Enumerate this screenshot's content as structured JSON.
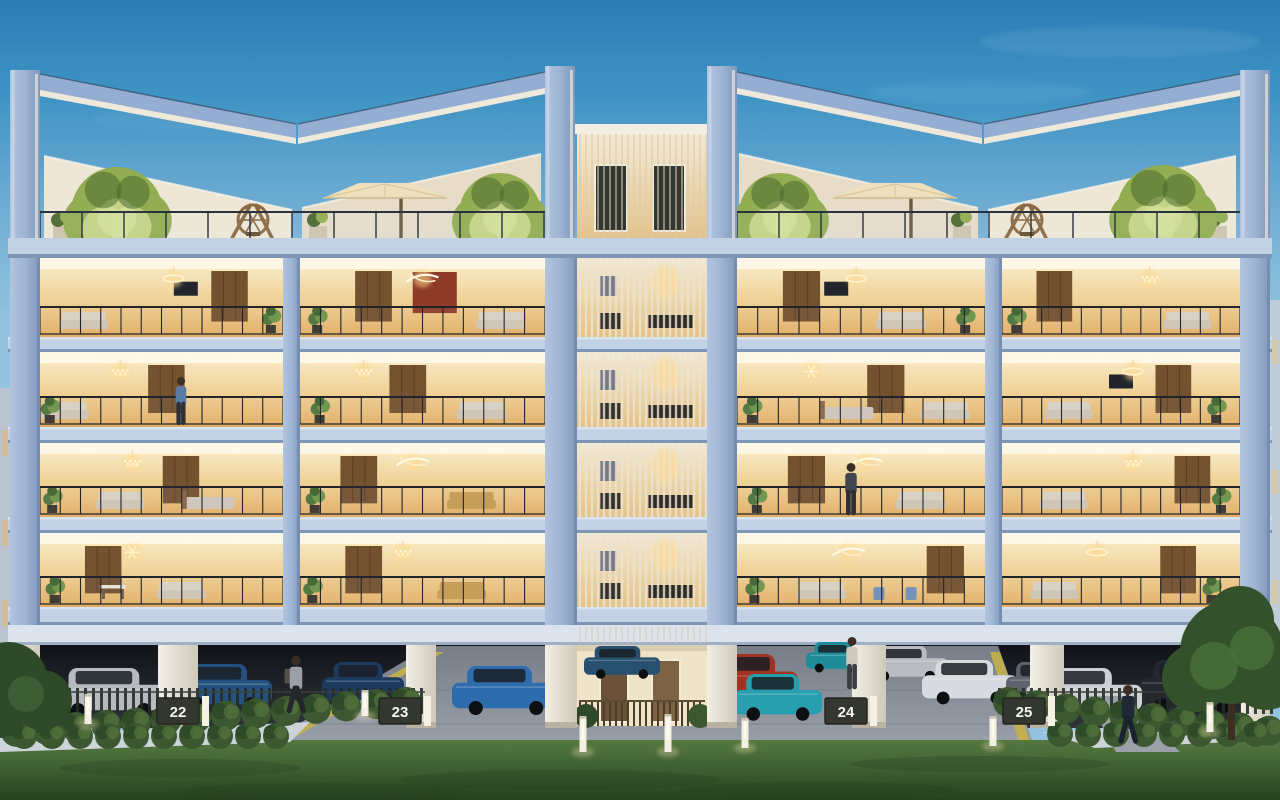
{
  "scene": {
    "type": "architectural-render",
    "subject": "Luxury low-rise apartment building at dusk",
    "details": "Four residential floors with warm-lit interiors and glass balconies, rooftop terraces with angular pergola frames, trees and parasols, central louvered core, stilt parking with cars and numbered bays, lawn and hedges in the foreground"
  },
  "colors": {
    "sky_top": "#2a7db6",
    "sky_mid": "#3f93c4",
    "sky_low": "#6fadd3",
    "sky_horizon": "#93c3de",
    "concrete": "#9db4d3",
    "concrete_light": "#b3c4dd",
    "concrete_dark": "#8097ba",
    "slab": "#c2d1e4",
    "slab_edge": "#7e96b6",
    "ceiling": "#fdf7e8",
    "interior_hi": "#f6e7c0",
    "interior_mid": "#f0d094",
    "interior_low": "#e3ad62",
    "railing": "#20252c",
    "louver": "#ece4d2",
    "louver_line": "#d8ccb4",
    "parapet": "#efe7d6",
    "parapet_shade": "#e6dcc8",
    "lit_edge": "#f6eedb",
    "tree_lit": "#d5e09a",
    "tree_mid": "#93ad52",
    "tree_dark": "#4c6a30",
    "umbrella": "#efe0bd",
    "lawn_top": "#567840",
    "lawn_mid": "#3f6132",
    "lawn_deep": "#27421f",
    "hedge": "#3c5830",
    "hedge_hi": "#5d7d42",
    "hedge_dark": "#2f4a28",
    "driveway_top": "#787e88",
    "driveway_bottom": "#9aa1ab",
    "stripe_yellow": "#c9b344",
    "park_dark": "#111318",
    "park_mid": "#23262d",
    "park_floor": "#2e323a",
    "pillar": "#e9e5da",
    "sign_bg": "#34372f",
    "sign_text": "#f5f5f0",
    "glow_warm": "#ffd98e",
    "curb": "#ccd3d9",
    "window_dark": "#31372f",
    "wood": "#8a6a42"
  },
  "tower": {
    "x": 577,
    "w": 130,
    "top": 130
  },
  "floors": {
    "bands": [
      [
        258,
        337
      ],
      [
        352,
        427
      ],
      [
        443,
        517
      ],
      [
        533,
        607
      ]
    ],
    "slabs": [
      [
        337,
        352
      ],
      [
        427,
        443
      ],
      [
        517,
        533
      ],
      [
        607,
        625
      ]
    ],
    "bays": [
      [
        40,
        283
      ],
      [
        300,
        545
      ],
      [
        737,
        985
      ],
      [
        1002,
        1240
      ]
    ],
    "piers": [
      [
        10,
        40
      ],
      [
        283,
        300
      ],
      [
        545,
        577
      ],
      [
        707,
        737
      ],
      [
        985,
        1002
      ],
      [
        1240,
        1270
      ]
    ]
  },
  "units": [
    {
      "f": 0,
      "b": 0,
      "c": "ring",
      "cx": 0.55,
      "w": 0.78,
      "s": 0.18,
      "p": 0.95,
      "tv": 0.6
    },
    {
      "f": 0,
      "b": 1,
      "c": "jet",
      "cx": 0.5,
      "w": 0.3,
      "s": 0.82,
      "p": 0.07,
      "accent": "#8e3b2a",
      "acx": 0.55
    },
    {
      "f": 0,
      "b": 2,
      "c": "ring",
      "cx": 0.48,
      "w": 0.26,
      "s": 0.66,
      "p": 0.92,
      "tv": 0.4
    },
    {
      "f": 0,
      "b": 3,
      "c": "crystal",
      "cx": 0.62,
      "w": 0.22,
      "s": 0.78,
      "p": 0.06
    },
    {
      "f": 1,
      "b": 0,
      "c": "crystal",
      "cx": 0.33,
      "w": 0.52,
      "s": 0.1,
      "p": 0.04
    },
    {
      "f": 1,
      "b": 1,
      "c": "crystal",
      "cx": 0.26,
      "w": 0.44,
      "s": 0.74,
      "p": 0.08
    },
    {
      "f": 1,
      "b": 2,
      "c": "spark",
      "cx": 0.3,
      "w": 0.6,
      "s": 0.84,
      "p": 0.06,
      "bed": 0.45
    },
    {
      "f": 1,
      "b": 3,
      "c": "ring",
      "cx": 0.55,
      "w": 0.72,
      "s": 0.28,
      "p": 0.9,
      "tv": 0.5
    },
    {
      "f": 2,
      "b": 0,
      "c": "crystal",
      "cx": 0.38,
      "w": 0.58,
      "s": 0.33,
      "p": 0.05,
      "bed": 0.7
    },
    {
      "f": 2,
      "b": 1,
      "c": "jet",
      "cx": 0.46,
      "w": 0.24,
      "s": 0.7,
      "p": 0.06,
      "sc": "#c49a52"
    },
    {
      "f": 2,
      "b": 2,
      "c": "jet",
      "cx": 0.52,
      "w": 0.28,
      "s": 0.74,
      "p": 0.08
    },
    {
      "f": 2,
      "b": 3,
      "c": "crystal",
      "cx": 0.55,
      "w": 0.8,
      "s": 0.26,
      "p": 0.92
    },
    {
      "f": 3,
      "b": 0,
      "c": "spark",
      "cx": 0.38,
      "w": 0.26,
      "s": 0.58,
      "p": 0.06,
      "table": 0.3
    },
    {
      "f": 3,
      "b": 1,
      "c": "crystal",
      "cx": 0.42,
      "w": 0.26,
      "s": 0.66,
      "p": 0.05,
      "sc": "#c49a52"
    },
    {
      "f": 3,
      "b": 2,
      "c": "jet",
      "cx": 0.45,
      "w": 0.84,
      "s": 0.34,
      "p": 0.07,
      "chairs": "#6f8fb5"
    },
    {
      "f": 3,
      "b": 3,
      "c": "ring",
      "cx": 0.4,
      "w": 0.74,
      "s": 0.22,
      "p": 0.88
    }
  ],
  "rooftop": {
    "trees": [
      {
        "cx": 117,
        "cy": 213,
        "r": 46
      },
      {
        "cx": 500,
        "cy": 214,
        "r": 41
      },
      {
        "cx": 780,
        "cy": 214,
        "r": 41
      },
      {
        "cx": 1163,
        "cy": 211,
        "r": 46
      }
    ],
    "umbrellas": [
      {
        "cx": 385,
        "cy": 198
      },
      {
        "cx": 895,
        "cy": 198
      }
    ],
    "swings": [
      {
        "cx": 253,
        "cy": 240
      },
      {
        "cx": 1027,
        "cy": 240
      }
    ],
    "planters": [
      {
        "x": 62
      },
      {
        "x": 318
      },
      {
        "x": 962
      },
      {
        "x": 1218
      }
    ]
  },
  "parking": {
    "signs": [
      {
        "label": "22",
        "cx": 178
      },
      {
        "label": "23",
        "cx": 400
      },
      {
        "label": "24",
        "cx": 846
      },
      {
        "label": "25",
        "cx": 1024
      }
    ],
    "pillars": [
      [
        10,
        40
      ],
      [
        158,
        198
      ],
      [
        406,
        436
      ],
      [
        545,
        577
      ],
      [
        707,
        737
      ],
      [
        852,
        886
      ],
      [
        1030,
        1064
      ],
      [
        1240,
        1270
      ]
    ],
    "cars": [
      {
        "x": 52,
        "w": 118,
        "h": 44,
        "base": 712,
        "color": "#b6bac1"
      },
      {
        "x": 176,
        "w": 96,
        "h": 42,
        "base": 706,
        "color": "#24517f"
      },
      {
        "x": 322,
        "w": 82,
        "h": 40,
        "base": 702,
        "color": "#1c3a5e"
      },
      {
        "x": 452,
        "w": 108,
        "h": 44,
        "base": 710,
        "color": "#2e6cae"
      },
      {
        "x": 584,
        "w": 76,
        "h": 30,
        "base": 676,
        "color": "#27506e"
      },
      {
        "x": 806,
        "w": 60,
        "h": 28,
        "base": 670,
        "color": "#1f8d99"
      },
      {
        "x": 866,
        "w": 82,
        "h": 32,
        "base": 678,
        "color": "#b9bdc3"
      },
      {
        "x": 922,
        "w": 96,
        "h": 40,
        "base": 700,
        "color": "#d7dade"
      },
      {
        "x": 710,
        "w": 88,
        "h": 46,
        "base": 700,
        "color": "#a03322"
      },
      {
        "x": 734,
        "w": 88,
        "h": 42,
        "base": 716,
        "color": "#279fae"
      },
      {
        "x": 1006,
        "w": 72,
        "h": 38,
        "base": 700,
        "color": "#5c636d"
      },
      {
        "x": 1026,
        "w": 116,
        "h": 44,
        "base": 712,
        "color": "#ccd0d5"
      },
      {
        "x": 1138,
        "w": 108,
        "h": 48,
        "base": 708,
        "color": "#23272e"
      }
    ],
    "bollards": [
      {
        "x": 88,
        "y": 694,
        "h": 30
      },
      {
        "x": 365,
        "y": 690,
        "h": 26
      },
      {
        "x": 583,
        "y": 716,
        "h": 36
      },
      {
        "x": 668,
        "y": 714,
        "h": 38
      },
      {
        "x": 745,
        "y": 718,
        "h": 30
      },
      {
        "x": 993,
        "y": 716,
        "h": 30
      },
      {
        "x": 1210,
        "y": 702,
        "h": 30
      }
    ]
  },
  "people": [
    {
      "role": "woman-walking-driveway",
      "x": 296,
      "foot": 712,
      "h": 57,
      "shirt": "#9aa0a6",
      "pants": "#23262b",
      "pose": "walk",
      "backpack": true
    },
    {
      "role": "man-standing-driveway",
      "x": 852,
      "foot": 688,
      "h": 52,
      "shirt": "#cfc9bb",
      "pants": "#3a3e45",
      "pose": "stand"
    },
    {
      "role": "man-in-suit-walking",
      "x": 1128,
      "foot": 742,
      "h": 58,
      "shirt": "#1e2836",
      "pants": "#1a222e",
      "pose": "walk"
    },
    {
      "role": "man-inside-apartment",
      "x": 181,
      "foot": 424,
      "h": 48,
      "shirt": "#5b7ba3",
      "pants": "#2c3038",
      "pose": "stand"
    },
    {
      "role": "man-on-balcony",
      "x": 851,
      "foot": 514,
      "h": 52,
      "shirt": "#41454d",
      "pants": "#2b2e33",
      "pose": "stand"
    }
  ]
}
